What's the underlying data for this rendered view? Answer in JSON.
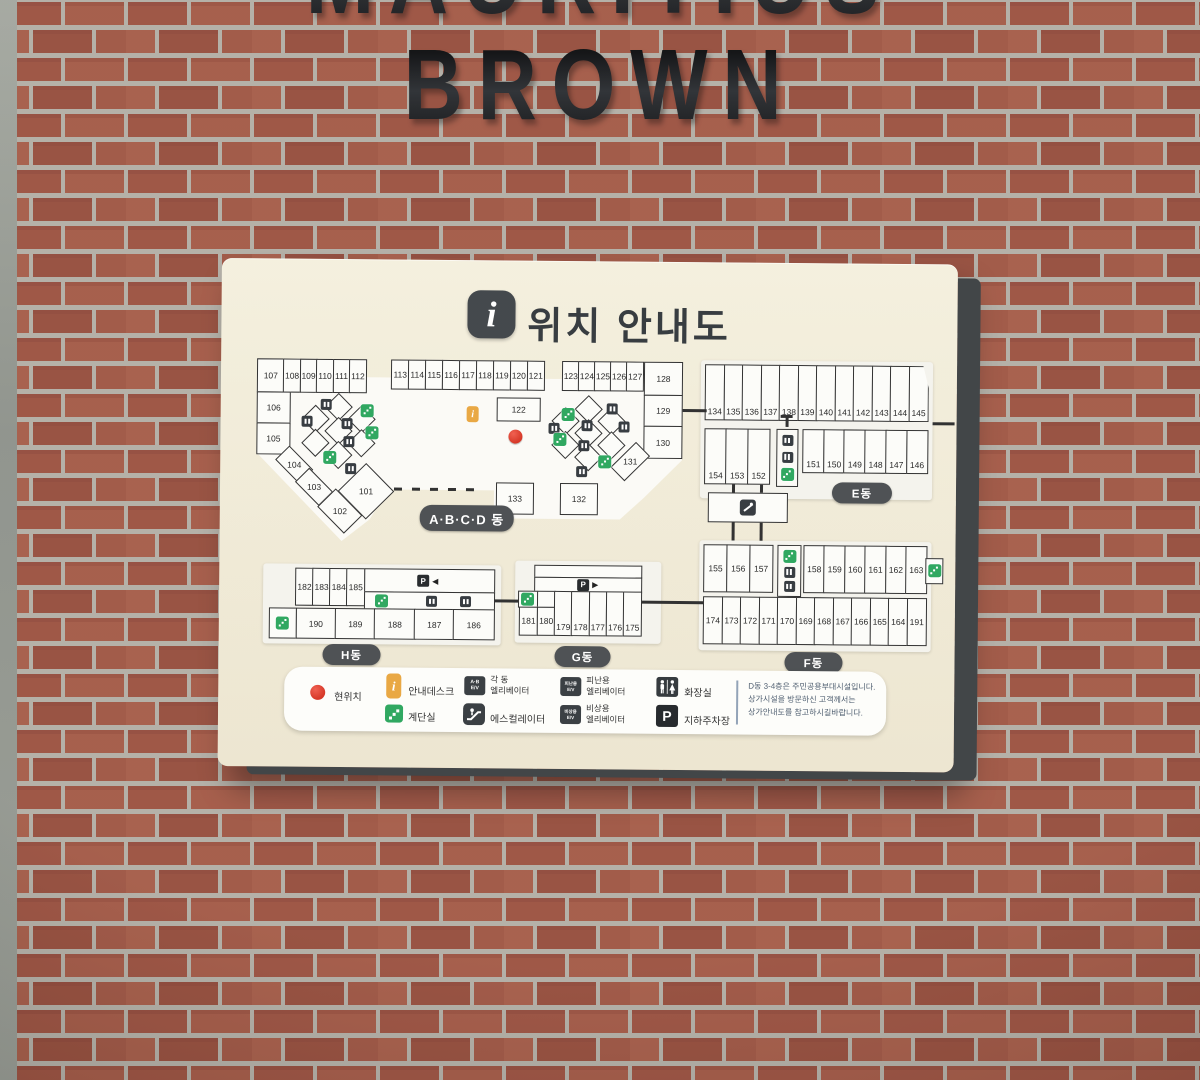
{
  "building_sign": {
    "top_word": "MAURITIUS",
    "bottom_word": "BROWN"
  },
  "header": {
    "title": "위치 안내도",
    "icon_glyph": "i"
  },
  "map": {
    "abcd": {
      "label": "A·B·C·D 동",
      "row1": [
        "107",
        "108",
        "109",
        "110",
        "111",
        "112"
      ],
      "row2": [
        "113",
        "114",
        "115",
        "116",
        "117",
        "118",
        "119",
        "120",
        "121"
      ],
      "row3": [
        "123",
        "124",
        "125",
        "126",
        "127"
      ],
      "left": [
        "106",
        "105"
      ],
      "diag": [
        "104",
        "103",
        "102"
      ],
      "room101": "101",
      "room122": "122",
      "right": [
        "128",
        "129",
        "130"
      ],
      "room131": "131",
      "room133": "133",
      "room132": "132"
    },
    "e": {
      "label": "E동",
      "row1": [
        "134",
        "135",
        "136",
        "137",
        "138",
        "139",
        "140",
        "141",
        "142",
        "143",
        "144",
        "145"
      ],
      "mid_left": [
        "154",
        "153",
        "152"
      ],
      "mid_right": [
        "151",
        "150",
        "149",
        "148",
        "147",
        "146"
      ]
    },
    "f": {
      "label": "F동",
      "top_left": [
        "155",
        "156",
        "157"
      ],
      "top_right": [
        "158",
        "159",
        "160",
        "161",
        "162",
        "163"
      ],
      "bottom": [
        "174",
        "173",
        "172",
        "171",
        "170",
        "169",
        "168",
        "167",
        "166",
        "165",
        "164",
        "191"
      ]
    },
    "g": {
      "label": "G동",
      "rooms_small": [
        "181",
        "180"
      ],
      "rooms": [
        "179",
        "178",
        "177",
        "176",
        "175"
      ],
      "parking_glyph": "P",
      "arrow": "▶"
    },
    "h": {
      "label": "H동",
      "row1": [
        "182",
        "183",
        "184",
        "185"
      ],
      "row2": [
        "190",
        "189",
        "188",
        "187",
        "186"
      ],
      "parking_glyph": "P",
      "arrow": "◀"
    }
  },
  "legend": {
    "current_location": "현위치",
    "info_desk": "안내데스크",
    "stairs": "계단실",
    "bldg_elev_line1": "각 동",
    "bldg_elev_line2": "엘리베이터",
    "escalator": "에스컬레이터",
    "evac_line1": "피난용",
    "evac_line2": "엘리베이터",
    "emer_line1": "비상용",
    "emer_line2": "엘리베이터",
    "restroom": "화장실",
    "parking": "지하주차장",
    "icon_ab_1": "A·B",
    "icon_ab_2": "E/V",
    "icon_evac_1": "피난용",
    "icon_evac_2": "E/V",
    "icon_emer_1": "비상용",
    "icon_emer_2": "E/V",
    "icon_parking": "P",
    "note1": "D동 3-4층은 주민공용부대시설입니다.",
    "note2": "상가시설을 방문하신 고객께서는",
    "note3": "상가안내도를 참고하시길바랍니다."
  },
  "colors": {
    "board": "#f1ebd8",
    "accent_green": "#28a45b",
    "accent_orange": "#e8a43c",
    "marker_red": "#d5301f",
    "pill_dark": "#484b4e"
  }
}
